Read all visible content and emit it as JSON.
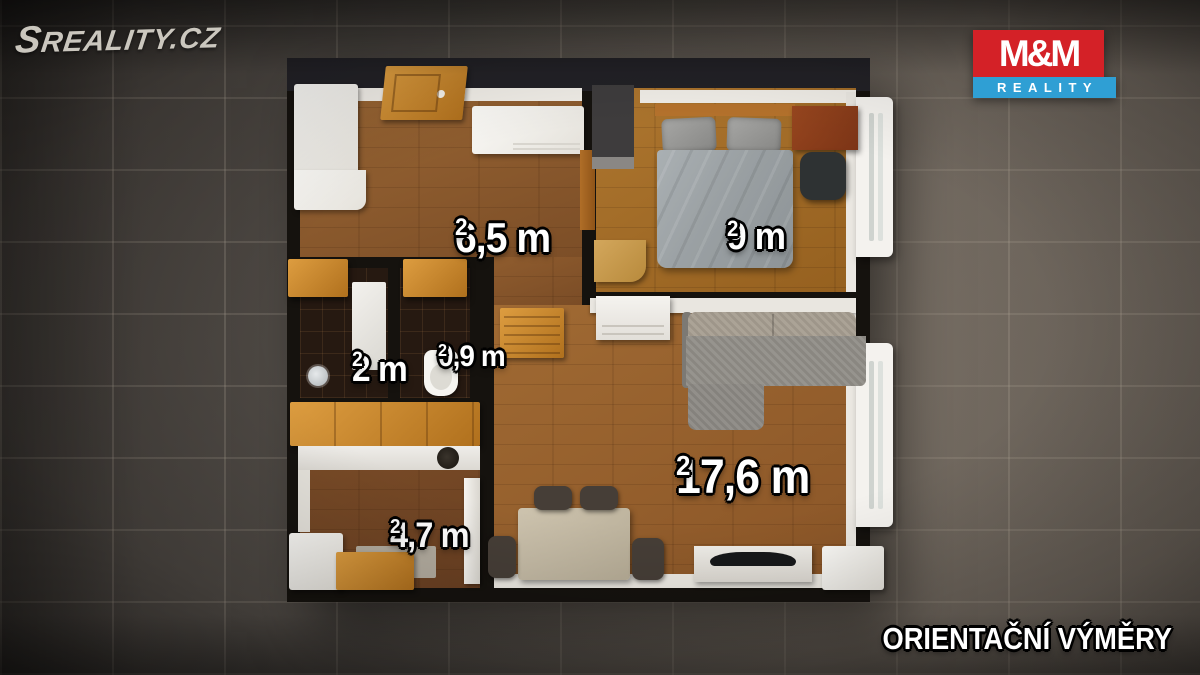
{
  "branding": {
    "watermark": "SREALITY.CZ",
    "logo": {
      "top": "M&M",
      "bottom": "REALITY",
      "red": "#d42127",
      "blue": "#2f9fd4"
    },
    "disclaimer": "ORIENTAČNÍ VÝMĚRY"
  },
  "rooms": {
    "hall": {
      "name": "hallway",
      "area": "6,5 m",
      "sup": "2"
    },
    "bedroom": {
      "name": "bedroom",
      "area": "9 m",
      "sup": "2"
    },
    "bathroom": {
      "name": "bathroom",
      "area": "2 m",
      "sup": "2"
    },
    "wc": {
      "name": "wc",
      "area": "0,9 m",
      "sup": "2"
    },
    "living": {
      "name": "living-room",
      "area": "17,6 m",
      "sup": "2"
    },
    "kitchen": {
      "name": "kitchen",
      "area": "4,7 m",
      "sup": "2"
    }
  },
  "colors": {
    "wall": "#15120e",
    "background_tile": "#57504a",
    "floor_hall": "#9a6634",
    "floor_bedroom": "#ad762f",
    "floor_living": "#a06a33",
    "floor_kitchen": "#7d4e28",
    "floor_bath_tile": "#261911",
    "label_text": "#ffffff"
  }
}
